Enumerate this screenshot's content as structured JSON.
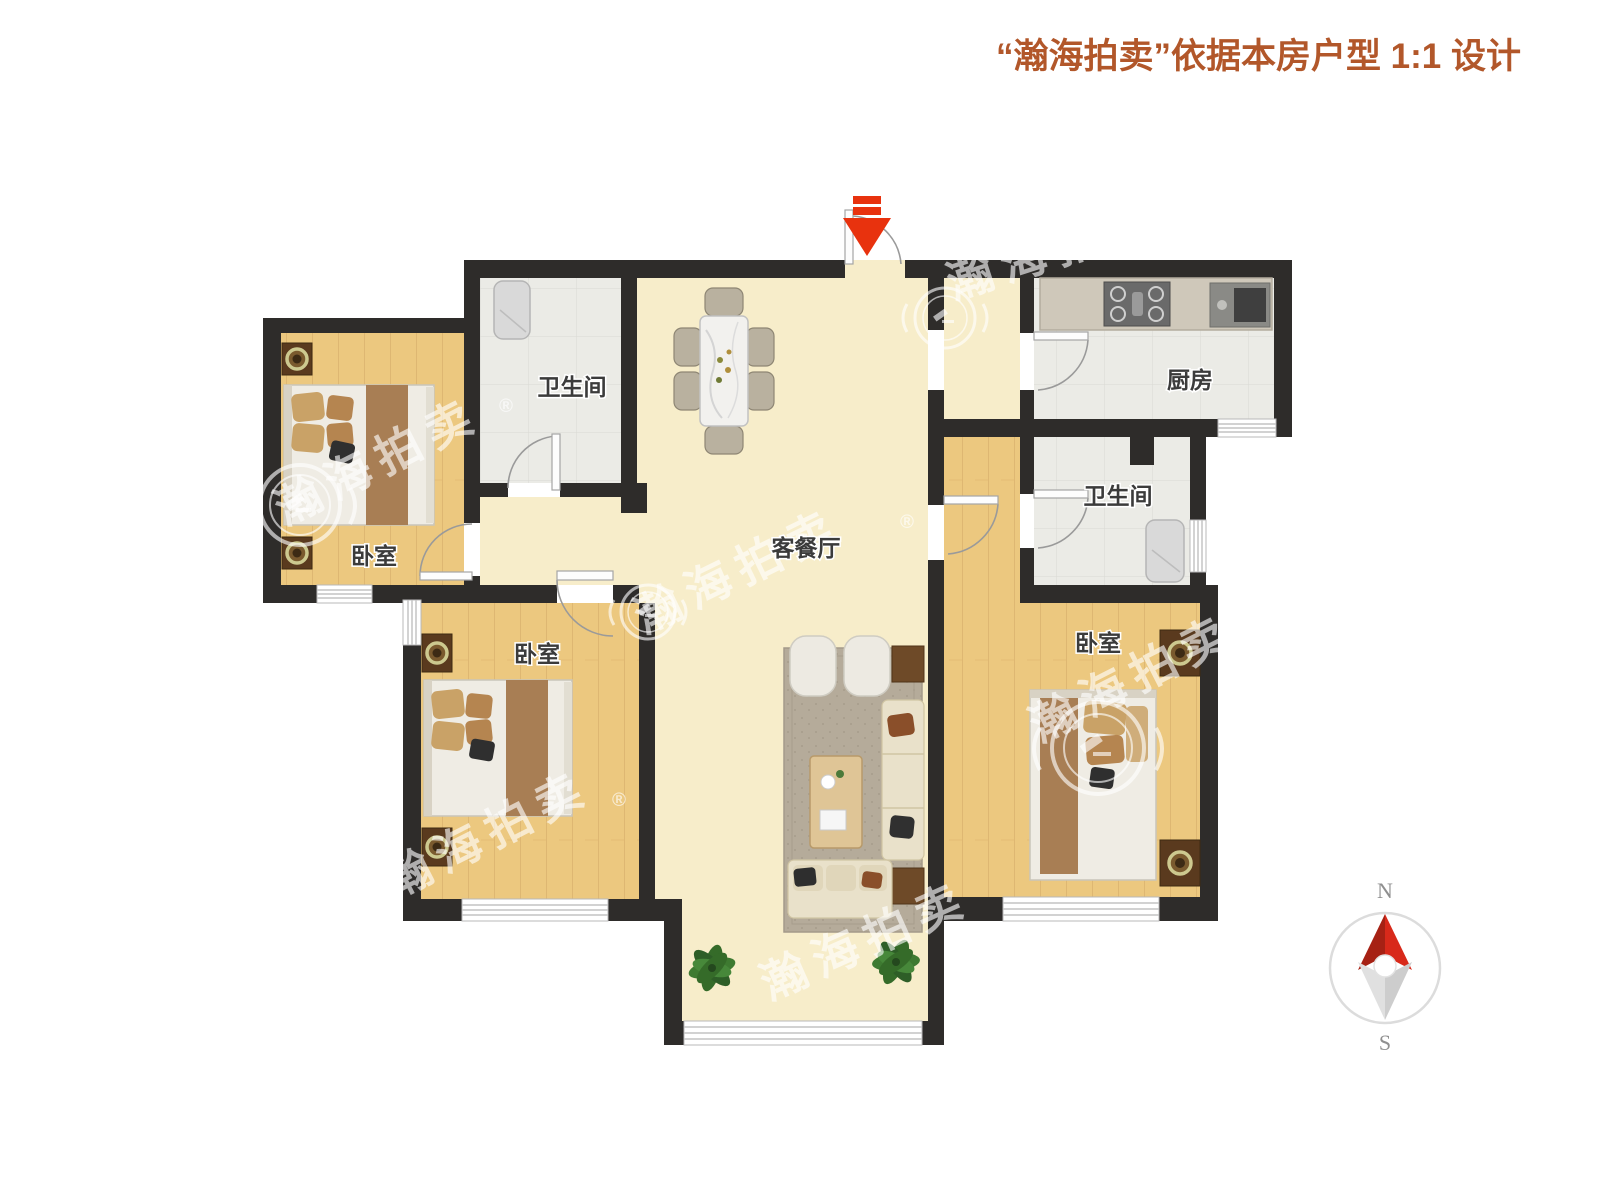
{
  "title": {
    "text": "“瀚海拍卖”依据本房户型 1:1 设计"
  },
  "watermark": {
    "text": "瀚海拍卖",
    "registered_mark": "®"
  },
  "compass": {
    "north_label": "N",
    "south_label": "S"
  },
  "rooms": {
    "bedroom_top_left": {
      "label": "卧室"
    },
    "bedroom_middle": {
      "label": "卧室"
    },
    "bedroom_right": {
      "label": "卧室"
    },
    "bathroom_left": {
      "label": "卫生间"
    },
    "bathroom_right": {
      "label": "卫生间"
    },
    "kitchen": {
      "label": "厨房"
    },
    "living_dining": {
      "label": "客餐厅"
    }
  },
  "icons": {
    "entry_arrow": "entry-direction-arrow",
    "compass": "north-compass",
    "logo": "hanhai-auction-laurel-gavel-logo"
  },
  "furniture_semantics": {
    "double_beds": 3,
    "nightstand_lamps": 6,
    "dining_chairs": 6,
    "dining_table": 1,
    "sofas": 2,
    "armchairs": 2,
    "coffee_table": 1,
    "showers": 2,
    "stove": 1,
    "sink": 1,
    "plants": 2
  },
  "colors": {
    "title": "#b2572a",
    "wall": "#2e2c2a",
    "floor-cream": "#f7edca",
    "floor-wood": "#ecc87f",
    "floor-tile": "#ebebe6",
    "arrow-red": "#e8320e",
    "compass-red": "#d8291a",
    "wm": "rgba(255,255,255,0.62)"
  }
}
